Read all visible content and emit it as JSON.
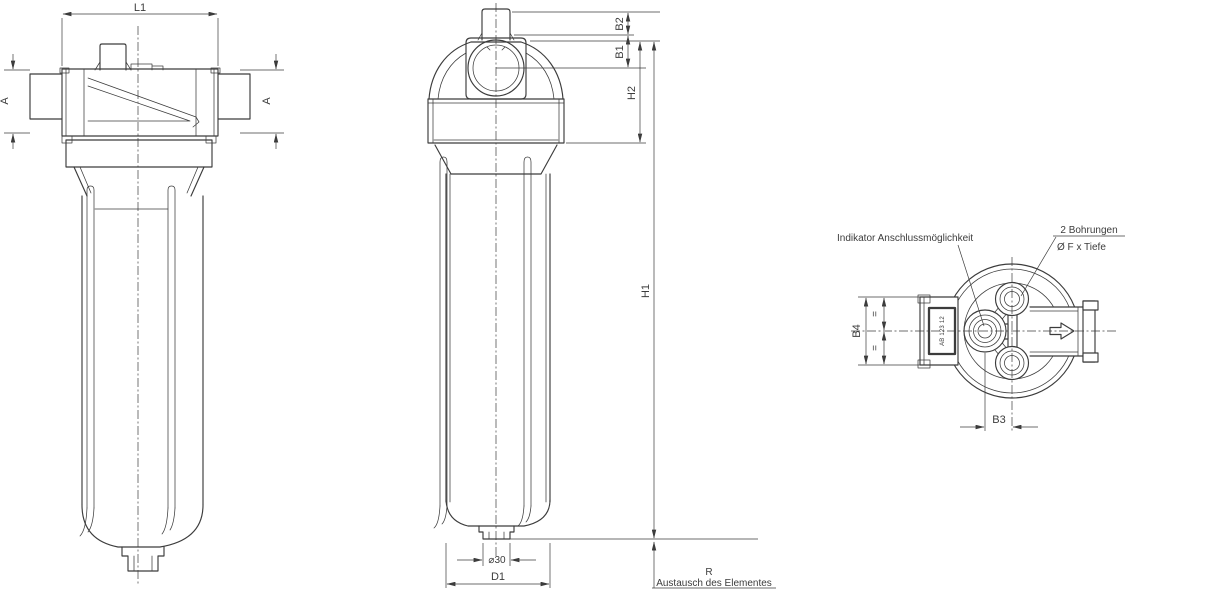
{
  "drawing": {
    "background": "#ffffff",
    "line_color": "#3c3c3c",
    "views": {
      "side_view": {
        "dim_l1": "L1",
        "dim_a_left": "A",
        "dim_a_right": "A"
      },
      "front_view": {
        "dim_b2": "B2",
        "dim_b1": "B1",
        "dim_h2": "H2",
        "dim_h1": "H1",
        "dim_drain": "⌀30",
        "dim_d1": "D1",
        "dim_r": "R",
        "note_r": "Austausch des Elementes"
      },
      "top_view": {
        "label_indicator": "Indikator Anschlussmöglichkeit",
        "label_holes_line1": "2 Bohrungen",
        "label_holes_line2": "Ø F x Tiefe",
        "dim_b4": "B4",
        "dim_b3": "B3",
        "equal_mark_top": "=",
        "equal_mark_bottom": "=",
        "port_marking": "AB 123 12"
      }
    }
  }
}
